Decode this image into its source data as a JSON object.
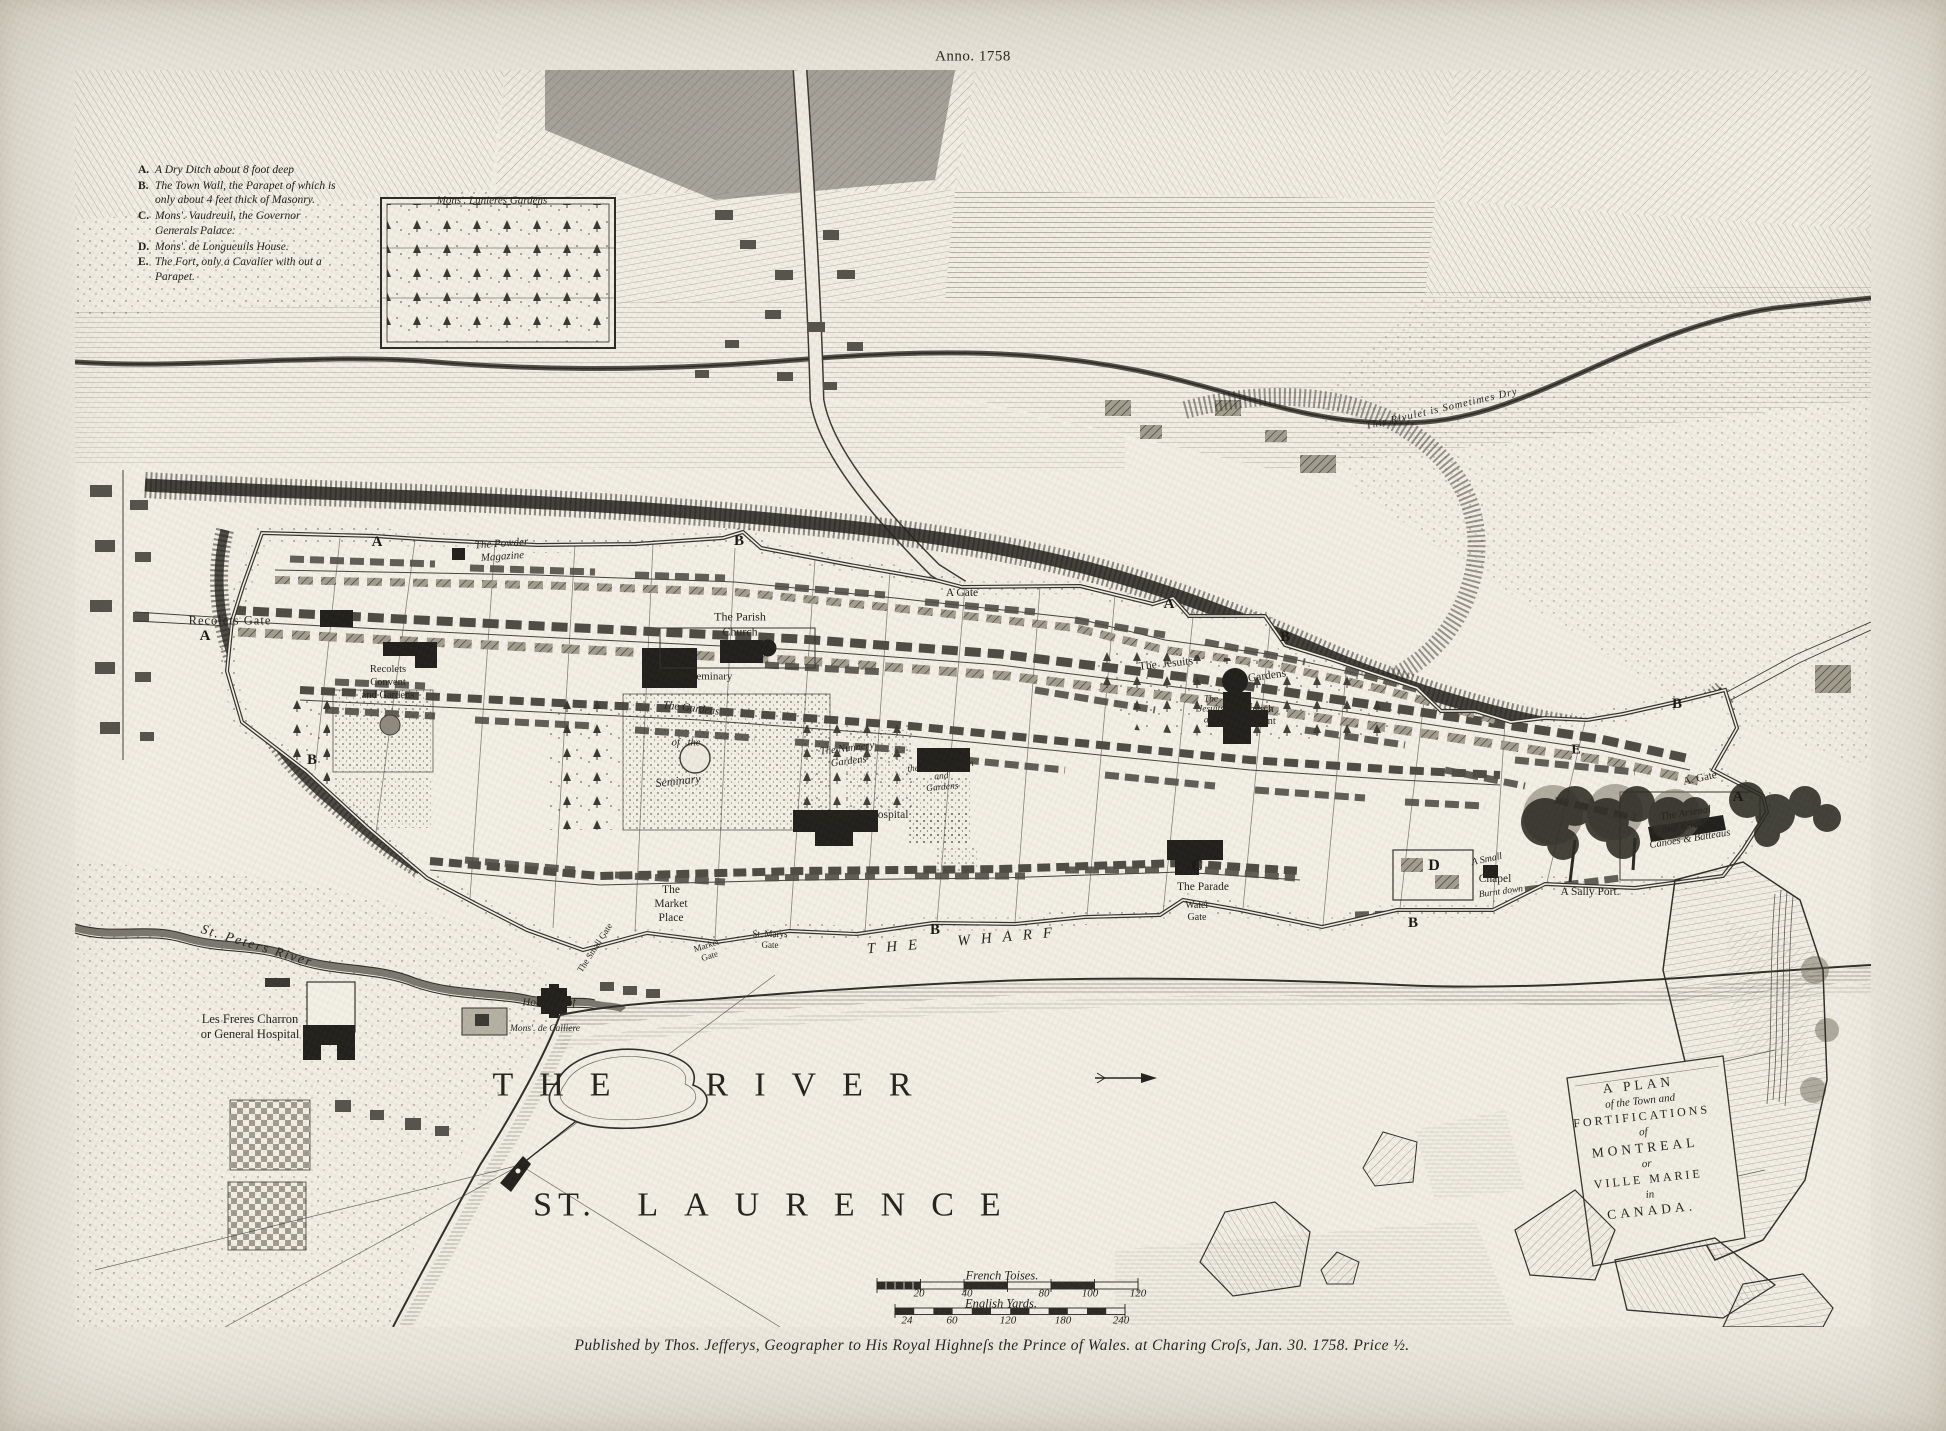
{
  "page": {
    "anno": "Anno. 1758",
    "imprint": "Published by Thos. Jefferys, Geographer to His Royal Highneſs the Prince of Wales. at Charing Croſs, Jan. 30. 1758. Price ½."
  },
  "legend": {
    "items": [
      {
        "key": "A.",
        "text": "A Dry Ditch about 8 foot deep"
      },
      {
        "key": "B.",
        "text": "The Town Wall, the Parapet of which is only about 4 feet thick of Masonry."
      },
      {
        "key": "C.",
        "text": "Mons'. Vaudreuil, the Governor Generals Palace."
      },
      {
        "key": "D.",
        "text": "Mons'. de Longueuils House."
      },
      {
        "key": "E.",
        "text": "The Fort, only a Cavalier with out a Parapet."
      }
    ]
  },
  "cartouche": {
    "lines": [
      "A PLAN",
      "of the Town and",
      "FORTIFICATIONS",
      "of",
      "MONTREAL",
      "or",
      "VILLE MARIE",
      "in",
      "CANADA."
    ]
  },
  "scales": {
    "french": {
      "label": "French Toises.",
      "ticks": [
        "20",
        "40",
        "80",
        "100",
        "120"
      ]
    },
    "english": {
      "label": "English Yards.",
      "ticks": [
        "24",
        "60",
        "120",
        "180",
        "240"
      ]
    }
  },
  "labels": [
    {
      "n": "marker-a-northwest",
      "t": "A",
      "x": 377,
      "y": 542,
      "s": 15,
      "b": 1
    },
    {
      "n": "marker-b-north",
      "t": "B",
      "x": 739,
      "y": 541,
      "s": 15,
      "b": 1
    },
    {
      "n": "marker-a-north",
      "t": "A",
      "x": 1169,
      "y": 604,
      "s": 15,
      "b": 1
    },
    {
      "n": "marker-b-northeast",
      "t": "B",
      "x": 1285,
      "y": 637,
      "s": 15,
      "b": 1
    },
    {
      "n": "marker-b-east",
      "t": "B",
      "x": 1677,
      "y": 704,
      "s": 15,
      "b": 1
    },
    {
      "n": "marker-a-west",
      "t": "A",
      "x": 205,
      "y": 636,
      "s": 15,
      "b": 1
    },
    {
      "n": "marker-b-southwest",
      "t": "B",
      "x": 312,
      "y": 760,
      "s": 15,
      "b": 1
    },
    {
      "n": "marker-b-south",
      "t": "B",
      "x": 935,
      "y": 930,
      "s": 15,
      "b": 1
    },
    {
      "n": "marker-b-southeast",
      "t": "B",
      "x": 1413,
      "y": 923,
      "s": 15,
      "b": 1
    },
    {
      "n": "marker-a-east",
      "t": "A",
      "x": 1738,
      "y": 797,
      "s": 15,
      "b": 1
    },
    {
      "n": "marker-c-governors-palace",
      "t": "C",
      "x": 1197,
      "y": 866,
      "s": 16,
      "b": 1
    },
    {
      "n": "marker-d-longueuil-house",
      "t": "D",
      "x": 1434,
      "y": 866,
      "s": 16,
      "b": 1
    },
    {
      "n": "marker-e-fort",
      "t": "E",
      "x": 1576,
      "y": 750,
      "s": 14,
      "b": 1
    },
    {
      "n": "label-a-gate-north",
      "t": "A Gate",
      "x": 962,
      "y": 593,
      "s": 11.5
    },
    {
      "n": "label-a-gate-east",
      "t": "A. Gate",
      "x": 1700,
      "y": 779,
      "s": 11,
      "r": -12
    },
    {
      "n": "label-recolets-gate",
      "t": "Recolets Gate",
      "x": 230,
      "y": 621,
      "s": 12.5,
      "ls": 1
    },
    {
      "n": "label-powder-magazine",
      "t": "The Powder\nMagazine",
      "x": 502,
      "y": 551,
      "s": 11,
      "i": 1,
      "r": -4
    },
    {
      "n": "label-parish-church",
      "t": "The Parish\nChurch",
      "x": 740,
      "y": 624,
      "s": 12
    },
    {
      "n": "label-seminary",
      "t": "The  Seminary",
      "x": 700,
      "y": 677,
      "s": 11
    },
    {
      "n": "label-seminary-gardens-1",
      "t": "The Gardens",
      "x": 691,
      "y": 709,
      "s": 11,
      "i": 1,
      "r": 7
    },
    {
      "n": "label-seminary-gardens-2",
      "t": "of   the",
      "x": 686,
      "y": 744,
      "s": 10.5,
      "i": 1
    },
    {
      "n": "label-seminary-gardens-3",
      "t": "Seminary",
      "x": 678,
      "y": 781,
      "s": 12,
      "i": 1,
      "r": -6
    },
    {
      "n": "label-recolets-convent",
      "t": "Recolets\nConvent\nand Gardens",
      "x": 388,
      "y": 683,
      "s": 10.5
    },
    {
      "n": "label-nunnery-gardens",
      "t": "The Nunnery\nGardens",
      "x": 848,
      "y": 756,
      "s": 10.5,
      "i": 1,
      "r": -7
    },
    {
      "n": "label-congregation-convent",
      "t": "Sisters of\nthe Congregation\nand\nGardens",
      "x": 941,
      "y": 772,
      "s": 9.5,
      "i": 1,
      "lh": 1.12,
      "r": -5
    },
    {
      "n": "label-nunnery-hospital",
      "t": "The Nunnery Hospital",
      "x": 857,
      "y": 815,
      "s": 11.5
    },
    {
      "n": "label-jesuits",
      "t": "The  Jesuits",
      "x": 1166,
      "y": 664,
      "s": 11.5,
      "r": -6
    },
    {
      "n": "label-jesuits-gardens",
      "t": "Gardens",
      "x": 1267,
      "y": 676,
      "s": 11.5,
      "r": -8
    },
    {
      "n": "label-jesuits-church-1",
      "t": "The\nJesuits\nand",
      "x": 1211,
      "y": 710,
      "s": 9.5,
      "i": 1,
      "lh": 1.1
    },
    {
      "n": "label-jesuits-church-2",
      "t": "Church\nConvent",
      "x": 1258,
      "y": 716,
      "s": 10.5,
      "lh": 1.15
    },
    {
      "n": "label-market-place",
      "t": "The\nMarket\nPlace",
      "x": 671,
      "y": 904,
      "s": 11.5
    },
    {
      "n": "label-small-gate",
      "t": "The Small Gate",
      "x": 595,
      "y": 948,
      "s": 9,
      "r": -57
    },
    {
      "n": "label-market-gate",
      "t": "Market\nGate",
      "x": 708,
      "y": 951,
      "s": 9,
      "r": -18
    },
    {
      "n": "label-st-marys-gate",
      "t": "St. Marys\nGate",
      "x": 770,
      "y": 940,
      "s": 9
    },
    {
      "n": "label-the-wharf",
      "t": "THE  WHARF",
      "x": 965,
      "y": 941,
      "s": 15,
      "i": 1,
      "ls": 11,
      "r": -5
    },
    {
      "n": "label-the-parade",
      "t": "The Parade",
      "x": 1203,
      "y": 887,
      "s": 11.5
    },
    {
      "n": "label-water-gate",
      "t": "Water\nGate",
      "x": 1197,
      "y": 912,
      "s": 10
    },
    {
      "n": "label-small-chapel-1",
      "t": "A Small",
      "x": 1487,
      "y": 860,
      "s": 10,
      "i": 1,
      "r": -12
    },
    {
      "n": "label-small-chapel-2",
      "t": "Chapel",
      "x": 1495,
      "y": 879,
      "s": 11.5
    },
    {
      "n": "label-burnt-down",
      "t": "Burnt down",
      "x": 1501,
      "y": 893,
      "s": 9.5,
      "i": 1,
      "r": -8
    },
    {
      "n": "label-sally-port",
      "t": "A Sally Port.",
      "x": 1590,
      "y": 892,
      "s": 11.5
    },
    {
      "n": "label-arsenal",
      "t": "The Arsenal\nand Yard for\nCanoes & Batteaus",
      "x": 1688,
      "y": 827,
      "s": 10.5,
      "i": 1,
      "r": -9
    },
    {
      "n": "label-rivulet",
      "t": "This Rivulet is Sometimes Dry",
      "x": 1442,
      "y": 410,
      "s": 10.5,
      "i": 1,
      "r": -13,
      "ls": 1
    },
    {
      "n": "label-lunieres-gardens",
      "t": "Mons'. Lunieres Gardens",
      "x": 492,
      "y": 201,
      "s": 11,
      "i": 1
    },
    {
      "n": "label-st-peters-river",
      "t": "St. Peters River",
      "x": 257,
      "y": 946,
      "s": 13.5,
      "i": 1,
      "r": 17,
      "ls": 2
    },
    {
      "n": "label-general-hospital",
      "t": "Les Freres Charron\nor General Hospital",
      "x": 250,
      "y": 1027,
      "s": 12.5
    },
    {
      "n": "label-house-of",
      "t": "House      of",
      "x": 549,
      "y": 1003,
      "s": 11,
      "i": 1
    },
    {
      "n": "label-calliere",
      "t": "Mons'. de Calliere",
      "x": 545,
      "y": 1030,
      "s": 9.5,
      "i": 1
    },
    {
      "n": "label-the-river",
      "t": "THE  RIVER",
      "x": 715,
      "y": 1085,
      "s": 34,
      "ls": 26
    },
    {
      "n": "label-st",
      "t": "ST.",
      "x": 565,
      "y": 1205,
      "s": 34,
      "ls": 6
    },
    {
      "n": "label-laurence",
      "t": "LAURENCE",
      "x": 832,
      "y": 1205,
      "s": 34,
      "ls": 26
    }
  ]
}
